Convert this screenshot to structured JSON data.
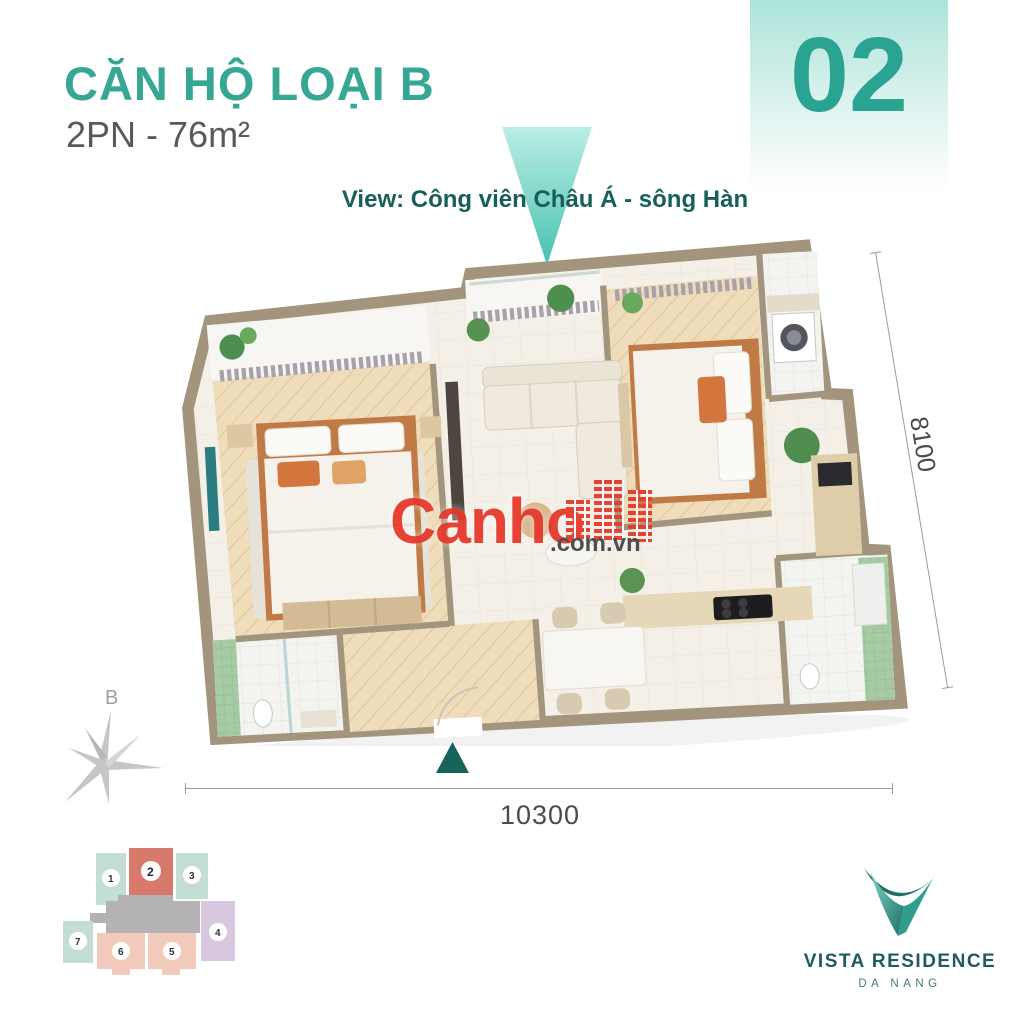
{
  "header": {
    "title": "CĂN HỘ LOẠI B",
    "subtitle": "2PN - 76m²",
    "title_color": "#36a794",
    "subtitle_color": "#58595b",
    "unit_number": "02",
    "badge_bg": "#abe3d9",
    "badge_text_color": "#2aa392"
  },
  "view": {
    "label": "View: Công viên Châu Á - sông Hàn",
    "text_color": "#175f58",
    "arrow_color": "#35bcab"
  },
  "plan": {
    "dimensions": {
      "right": "8100",
      "bottom": "10300",
      "text_color": "#4b4b4b",
      "line_color": "#9b9b9b"
    },
    "entry_arrow_color": "#16635c",
    "wall_color": "#a3957d",
    "wood_floor_color": "#eedcba",
    "tile_floor_color": "#f4f0e8",
    "bathroom_tile_color": "#a6cba4",
    "accent_orange": "#d2763d",
    "tv_art_color": "#2b7d82"
  },
  "compass": {
    "north_label": "B",
    "color": "#c6c6c9"
  },
  "watermark": {
    "brand": "Canho",
    "domain": ".com.vn",
    "brand_color": "#e6392d",
    "domain_color": "#46464a"
  },
  "minimap": {
    "core_color": "#b5b2b5",
    "units": [
      {
        "number": "1",
        "color": "#c3ded2",
        "highlighted": false
      },
      {
        "number": "2",
        "color": "#d87a6b",
        "highlighted": true
      },
      {
        "number": "3",
        "color": "#c3ded2",
        "highlighted": false
      },
      {
        "number": "4",
        "color": "#d9c7e0",
        "highlighted": false
      },
      {
        "number": "5",
        "color": "#f2cabc",
        "highlighted": false
      },
      {
        "number": "6",
        "color": "#f2cabc",
        "highlighted": false
      },
      {
        "number": "7",
        "color": "#c3ded2",
        "highlighted": false
      }
    ]
  },
  "logo": {
    "name": "VISTA RESIDENCE",
    "city": "DA NANG",
    "name_color": "#1d5b5d",
    "mark_colors": [
      "#1f6f66",
      "#2f9c8d",
      "#7fd4c6"
    ]
  }
}
